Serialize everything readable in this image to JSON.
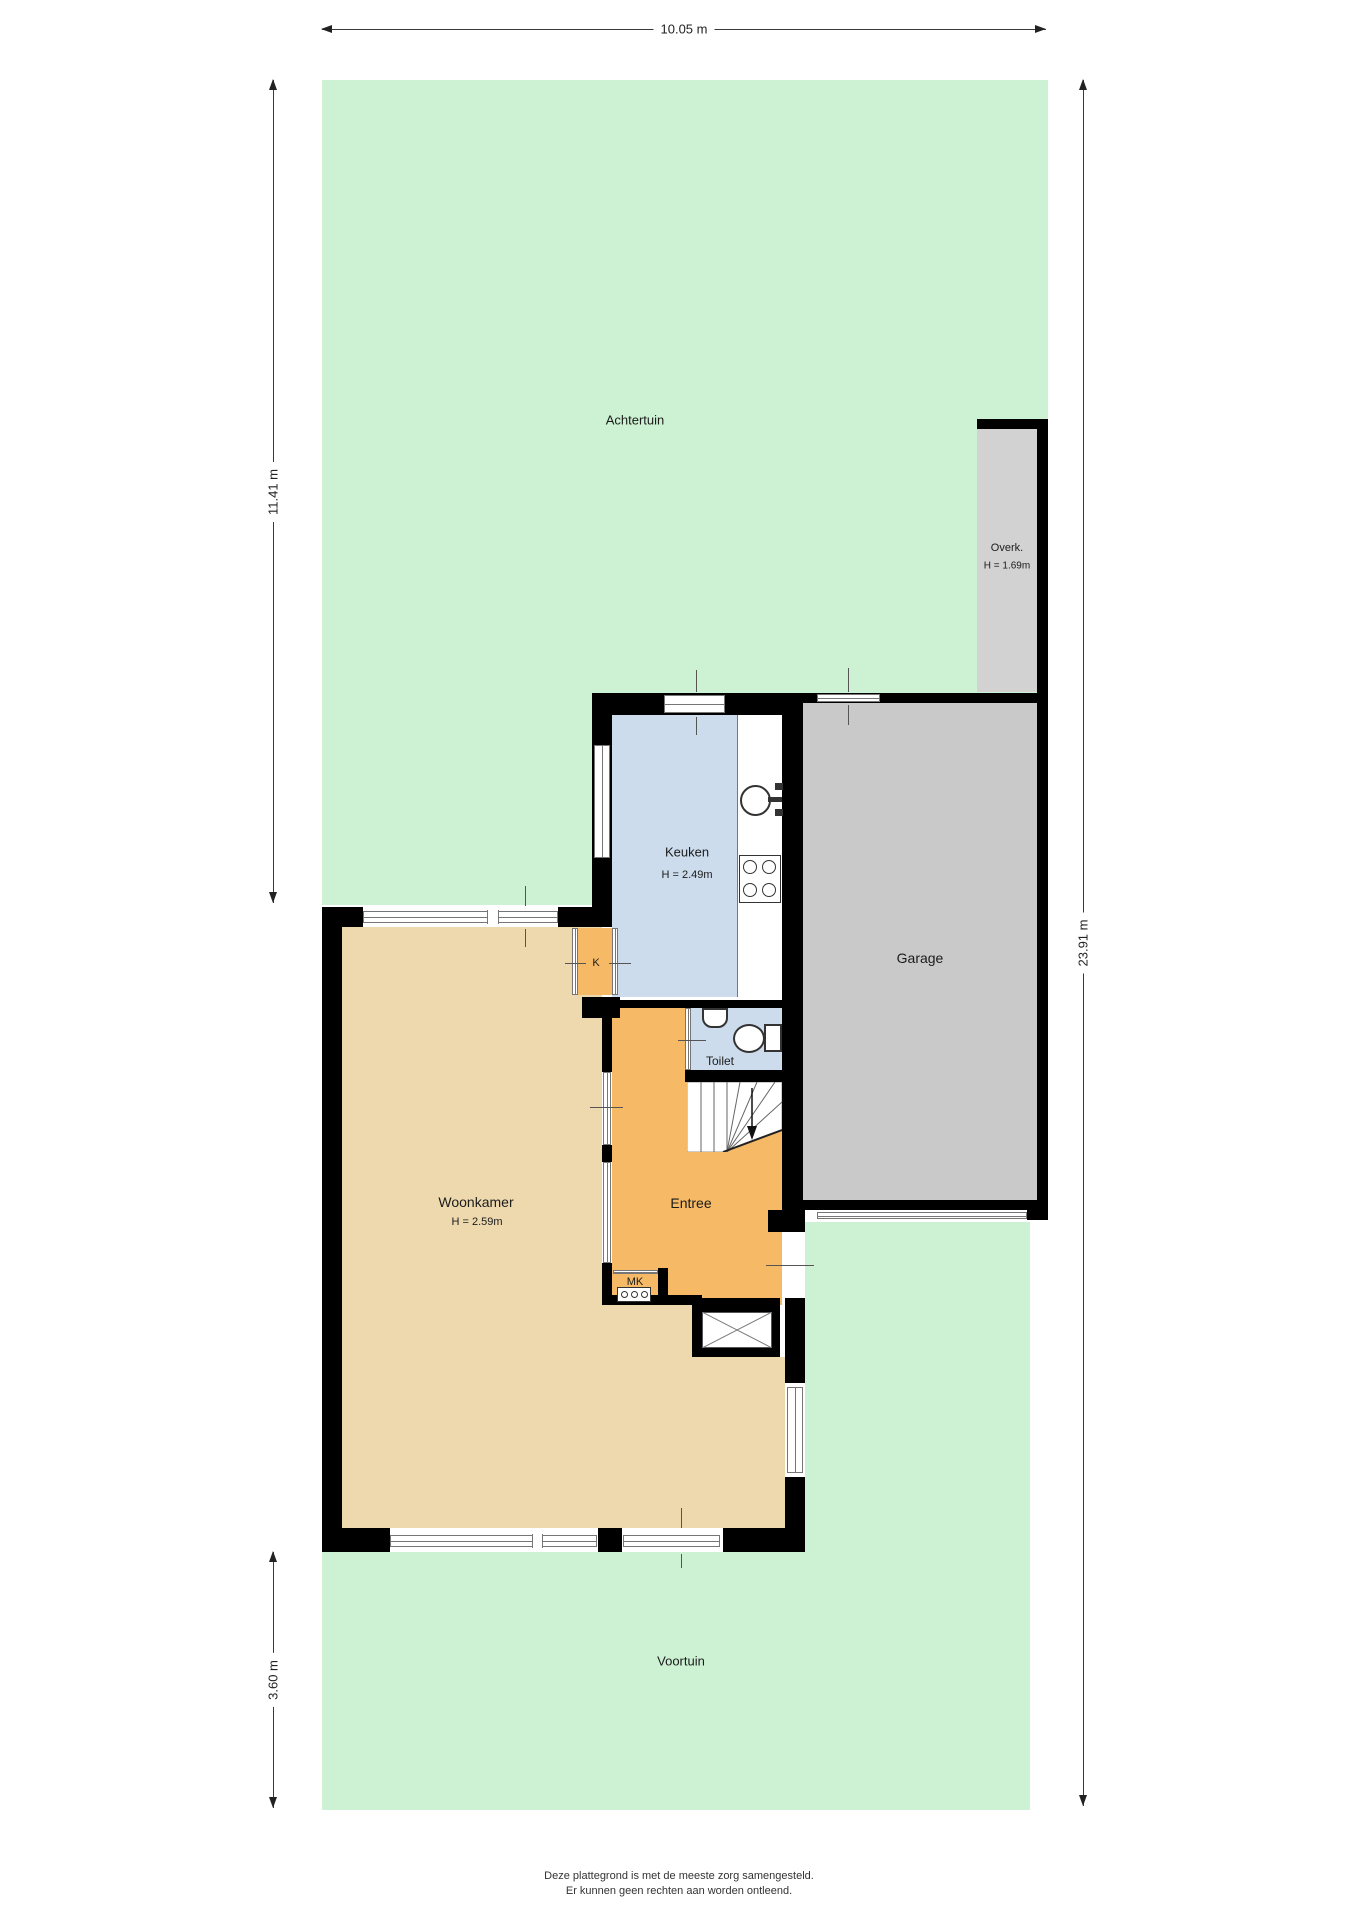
{
  "dimensions": {
    "top": "10.05 m",
    "left_back_garden": "11.41 m",
    "left_front_garden": "3.60 m",
    "right_total": "23.91 m"
  },
  "areas": {
    "back_garden": {
      "label": "Achtertuin"
    },
    "front_garden": {
      "label": "Voortuin"
    },
    "canopy": {
      "label": "Overk.",
      "height": "H = 1.69m"
    },
    "kitchen": {
      "label": "Keuken",
      "height": "H = 2.49m"
    },
    "garage": {
      "label": "Garage"
    },
    "living_room": {
      "label": "Woonkamer",
      "height": "H = 2.59m"
    },
    "hall": {
      "label": "Entree"
    },
    "toilet": {
      "label": "Toilet"
    },
    "closet": {
      "label": "K"
    },
    "meter_closet": {
      "label": "MK"
    }
  },
  "footer": {
    "line1": "Deze plattegrond is met de meeste zorg samengesteld.",
    "line2": "Er kunnen geen rechten aan worden ontleend."
  },
  "colors": {
    "garden": "#cdf2d3",
    "living_room": "#eed9af",
    "hall": "#f6ba66",
    "kitchen_toilet": "#ccdcec",
    "garage": "#c9c9c9",
    "canopy": "#d2d2d2",
    "wall": "#000000"
  }
}
